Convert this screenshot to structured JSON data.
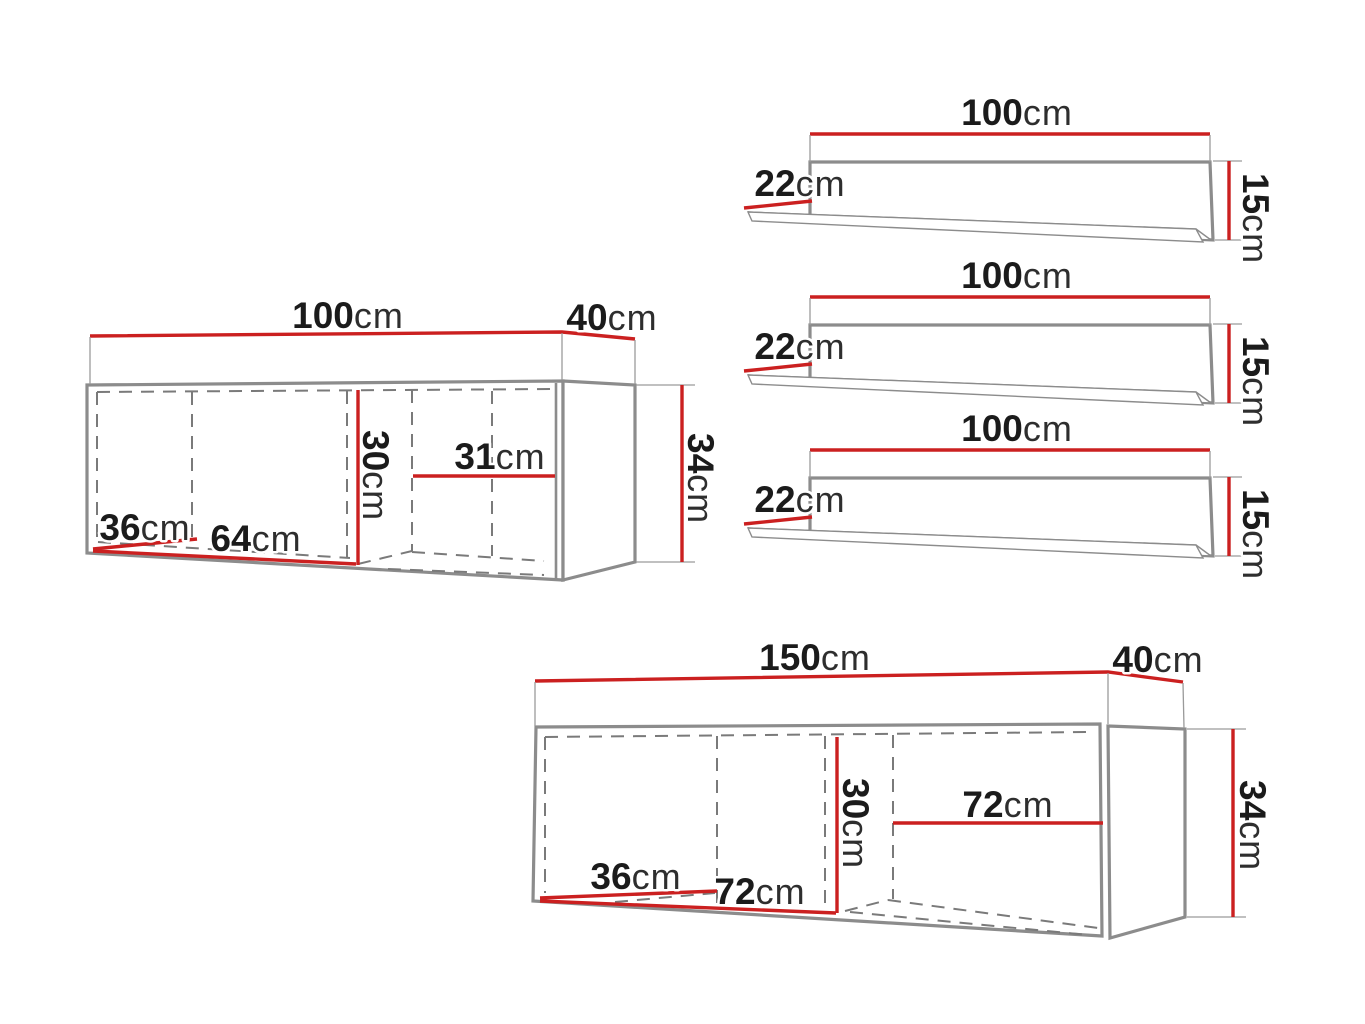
{
  "diagram_title": "Furniture set dimension drawing",
  "colors": {
    "dimension_line": "#cb2020",
    "outline": "#8c8c8c",
    "hidden_edge_dash": "#7a7a7a",
    "label_number": "#1b1b1b",
    "label_unit": "#2e2e2e",
    "background": "#ffffff"
  },
  "pieces": {
    "shelf_1": {
      "type": "wall shelf",
      "width": {
        "num": "100",
        "unit": "cm"
      },
      "depth": {
        "num": "22",
        "unit": "cm"
      },
      "height": {
        "num": "15",
        "unit": "cm"
      }
    },
    "shelf_2": {
      "type": "wall shelf",
      "width": {
        "num": "100",
        "unit": "cm"
      },
      "depth": {
        "num": "22",
        "unit": "cm"
      },
      "height": {
        "num": "15",
        "unit": "cm"
      }
    },
    "shelf_3": {
      "type": "wall shelf",
      "width": {
        "num": "100",
        "unit": "cm"
      },
      "depth": {
        "num": "22",
        "unit": "cm"
      },
      "height": {
        "num": "15",
        "unit": "cm"
      }
    },
    "cabinet_100": {
      "type": "wall cabinet",
      "width": {
        "num": "100",
        "unit": "cm"
      },
      "depth": {
        "num": "40",
        "unit": "cm"
      },
      "height": {
        "num": "34",
        "unit": "cm"
      },
      "interior_height": {
        "num": "30",
        "unit": "cm"
      },
      "interior_right_width": {
        "num": "31",
        "unit": "cm"
      },
      "interior_depth": {
        "num": "36",
        "unit": "cm"
      },
      "interior_left_width": {
        "num": "64",
        "unit": "cm"
      }
    },
    "cabinet_150": {
      "type": "wall cabinet",
      "width": {
        "num": "150",
        "unit": "cm"
      },
      "depth": {
        "num": "40",
        "unit": "cm"
      },
      "height": {
        "num": "34",
        "unit": "cm"
      },
      "interior_height": {
        "num": "30",
        "unit": "cm"
      },
      "interior_right_width": {
        "num": "72",
        "unit": "cm"
      },
      "interior_depth": {
        "num": "36",
        "unit": "cm"
      },
      "interior_left_width": {
        "num": "72",
        "unit": "cm"
      }
    }
  }
}
